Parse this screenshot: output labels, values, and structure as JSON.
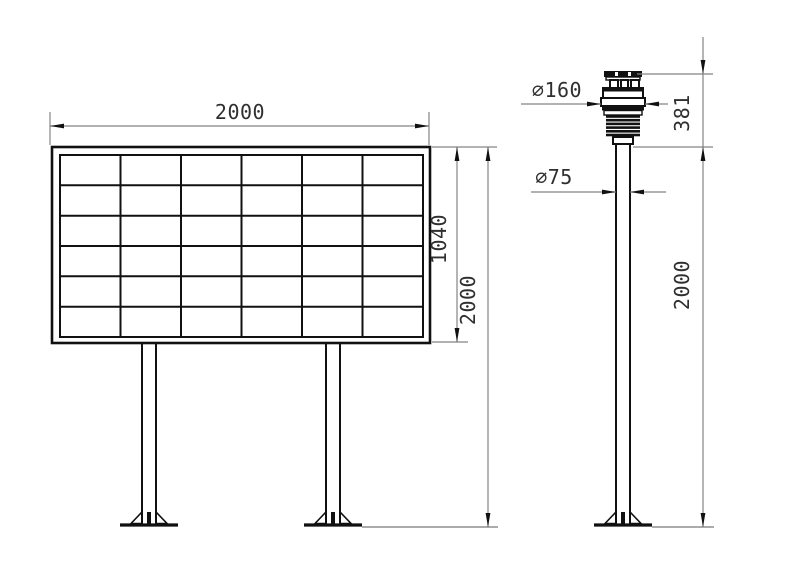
{
  "board_figure": {
    "label": "display-board-front-view",
    "grid_rows": 6,
    "grid_cols": 6,
    "dim_width": "2000",
    "dim_panel_height": "1040",
    "dim_total_height": "2000"
  },
  "station_figure": {
    "label": "weather-station-side-view",
    "dim_sensor_diameter": "∅160",
    "dim_sensor_height": "381",
    "dim_pole_diameter": "∅75",
    "dim_pole_height": "2000"
  },
  "colors": {
    "object_line": "#111111",
    "dimension_line": "#848484",
    "dimension_text": "#2f2f2f",
    "background": "#ffffff"
  }
}
